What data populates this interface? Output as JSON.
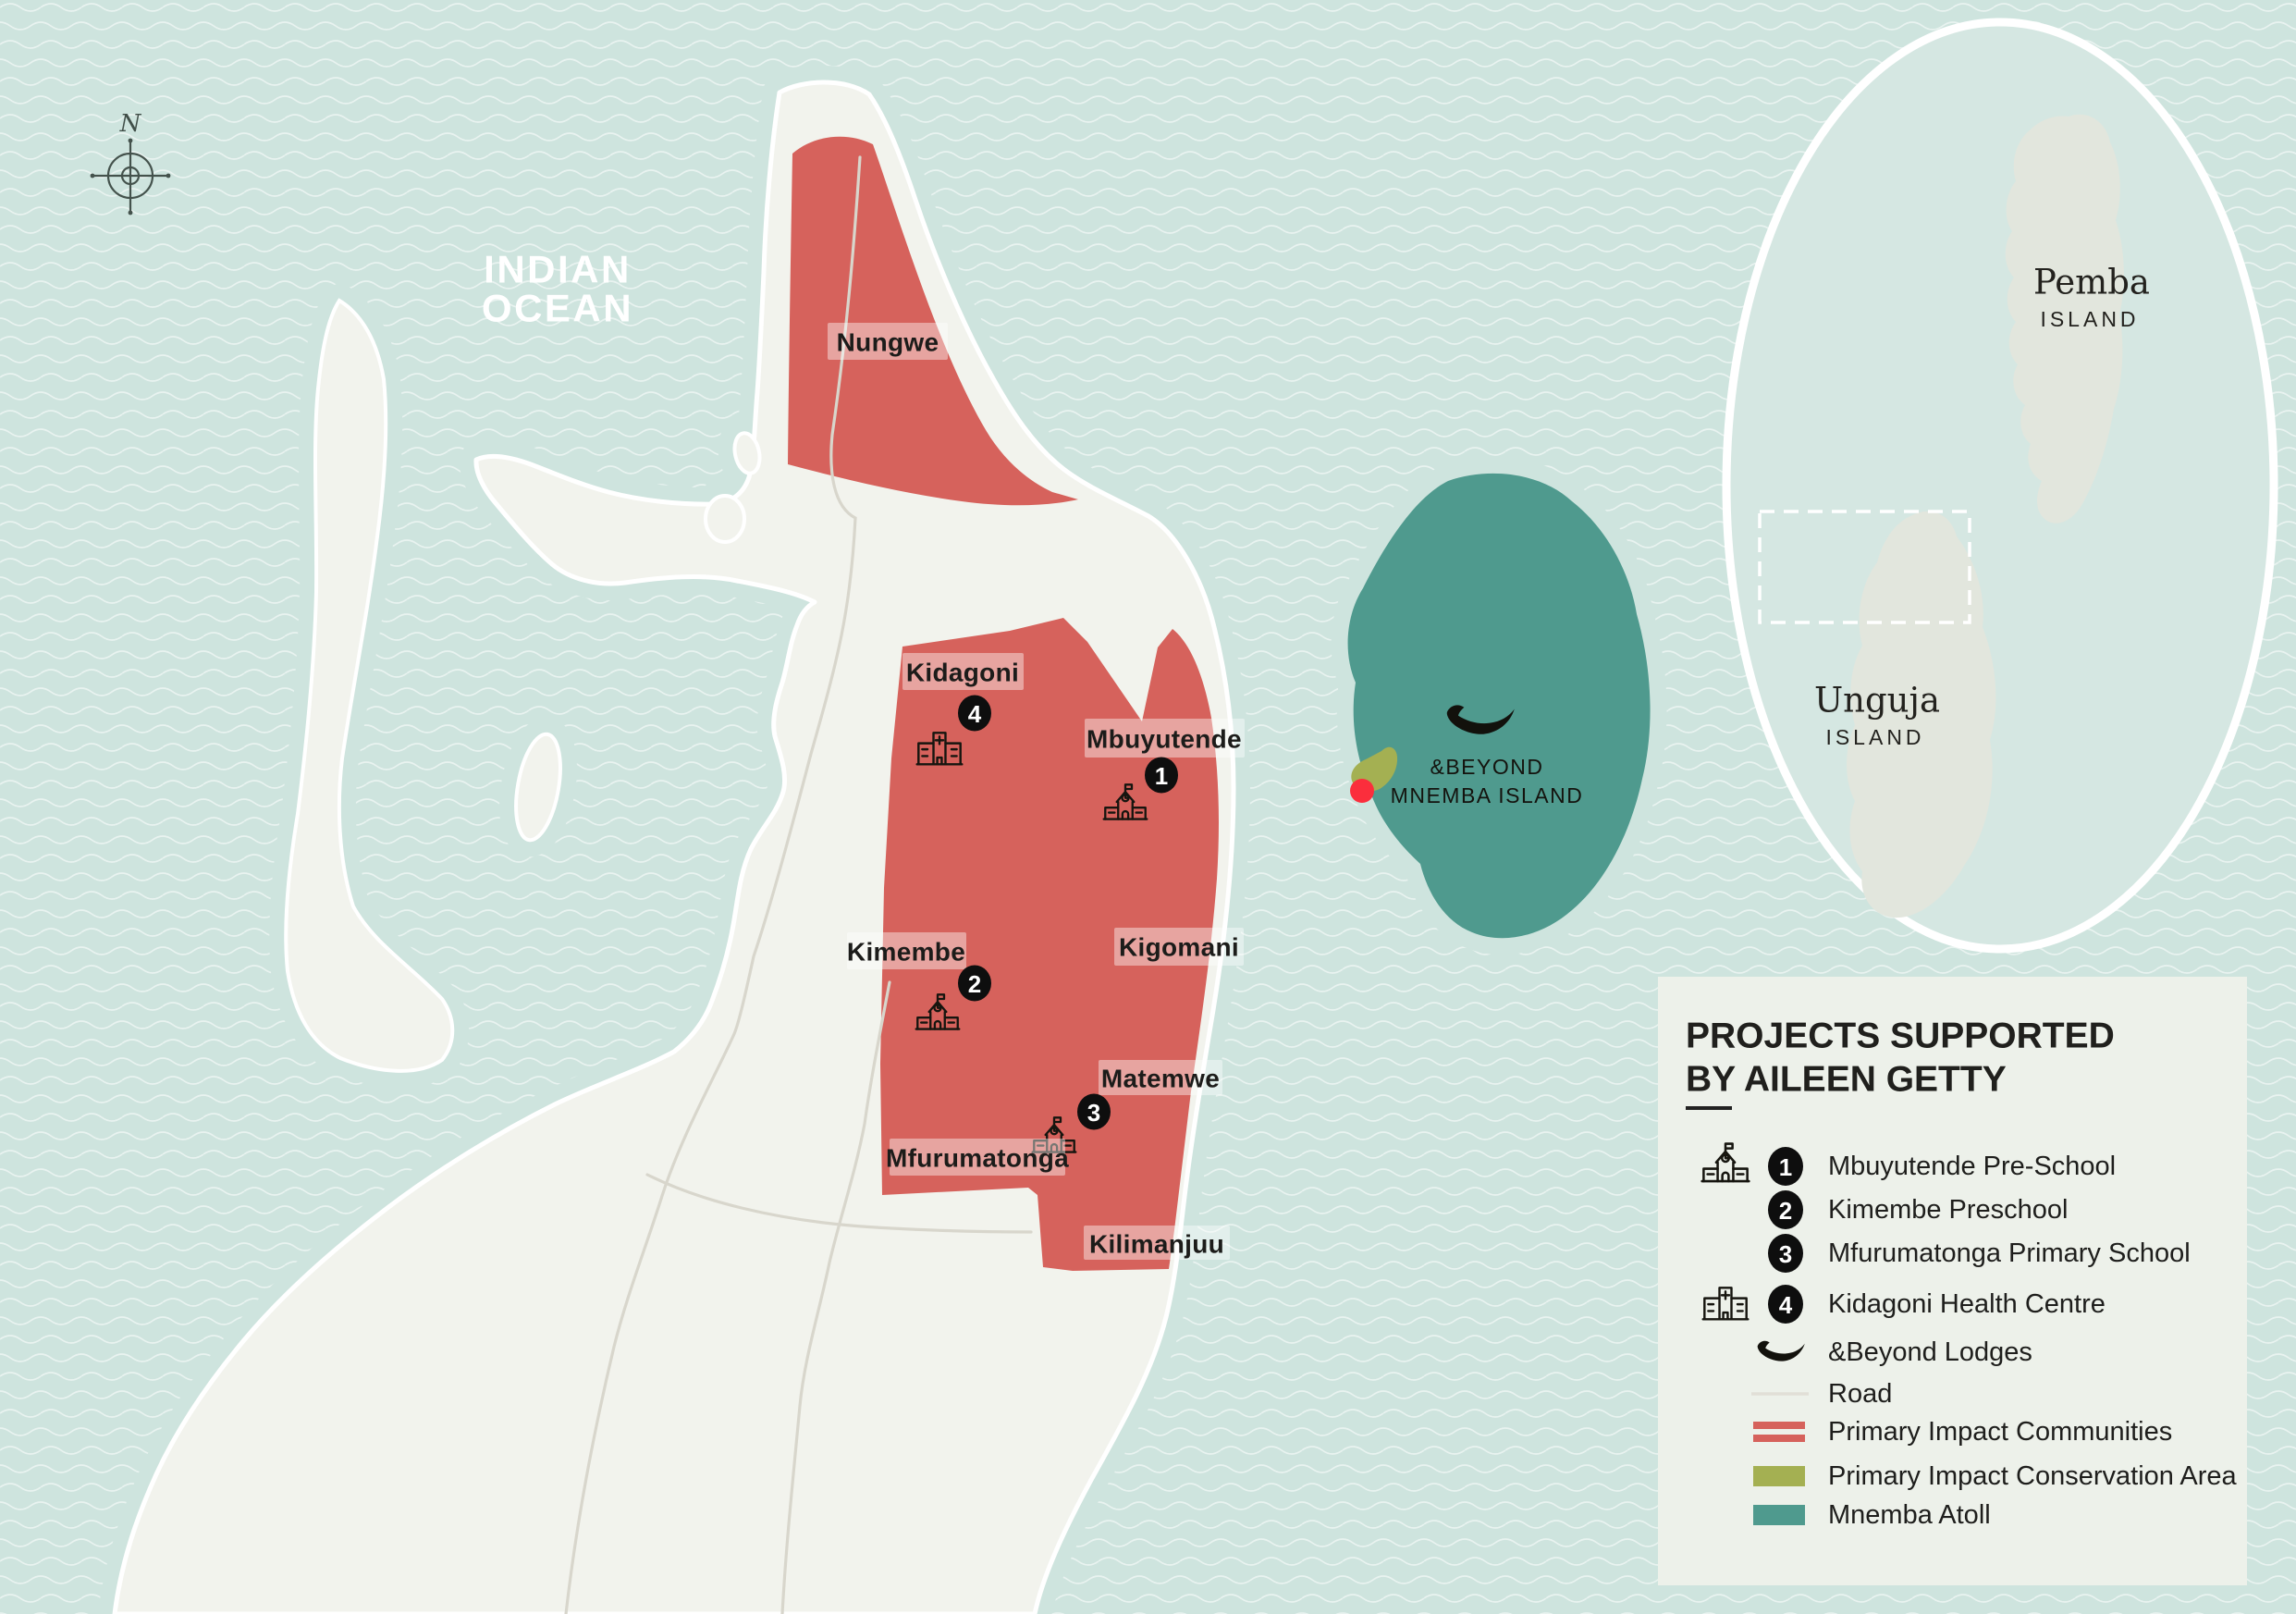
{
  "map": {
    "ocean_label": {
      "line1": "INDIAN",
      "line2": "OCEAN"
    },
    "compass": {
      "north_label": "N"
    },
    "places": [
      {
        "label": "Nungwe"
      },
      {
        "label": "Kidagoni",
        "marker": "4"
      },
      {
        "label": "Mbuyutende",
        "marker": "1"
      },
      {
        "label": "Kimembe",
        "marker": "2"
      },
      {
        "label": "Kigomani"
      },
      {
        "label": "Matemwe",
        "marker": "3"
      },
      {
        "label": "Mfurumatonga"
      },
      {
        "label": "Kilimanjuu"
      }
    ],
    "mnemba": {
      "line1": "&BEYOND",
      "line2": "MNEMBA ISLAND"
    },
    "inset": {
      "pemba_name": "Pemba",
      "pemba_sub": "ISLAND",
      "unguja_name": "Unguja",
      "unguja_sub": "ISLAND"
    }
  },
  "legend": {
    "title_line1": "PROJECTS SUPPORTED",
    "title_line2": "BY AILEEN GETTY",
    "items": [
      {
        "number": "1",
        "label": "Mbuyutende Pre-School"
      },
      {
        "number": "2",
        "label": "Kimembe Preschool"
      },
      {
        "number": "3",
        "label": "Mfurumatonga Primary School"
      },
      {
        "number": "4",
        "label": "Kidagoni Health Centre"
      },
      {
        "label": "&Beyond Lodges"
      },
      {
        "label": "Road"
      },
      {
        "label": "Primary Impact Communities"
      },
      {
        "label": "Primary Impact Conservation Area"
      },
      {
        "label": "Mnemba Atoll"
      }
    ]
  },
  "colors": {
    "ocean": "#cee4de",
    "island": "#f2f3ed",
    "primary_communities": "#d6625c",
    "conservation_area": "#a4b052",
    "mnemba_atoll": "#4f9a8e",
    "lodge_dot": "#fb2e3c",
    "road": "#d8d6cc",
    "legend_background": "#edf1ea"
  }
}
